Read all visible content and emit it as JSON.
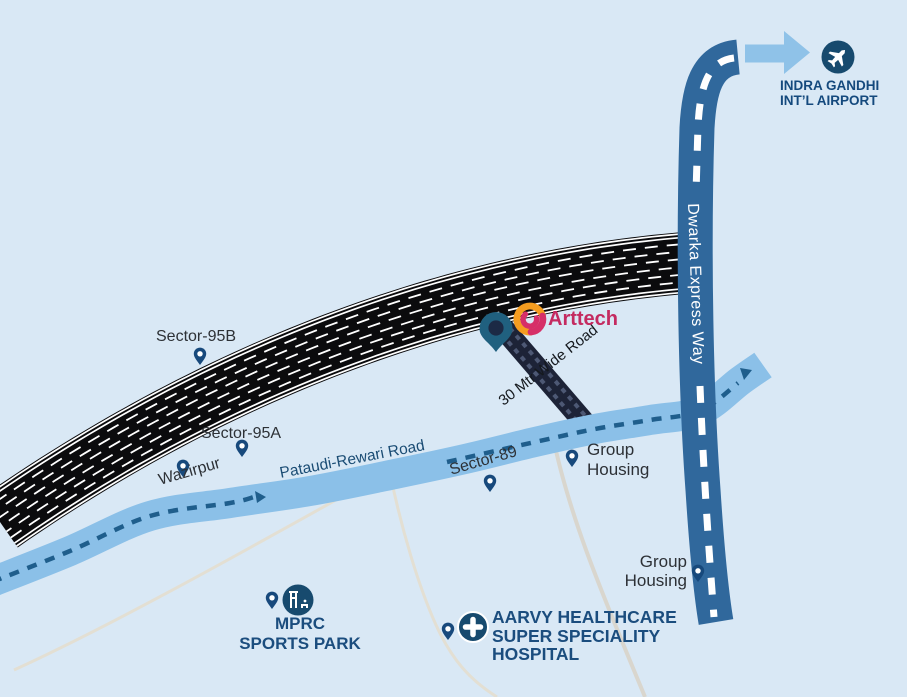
{
  "map_title": "Arttech site location map",
  "colors": {
    "background": "#d9e8f5",
    "highway": "#0b0b0d",
    "marking": "#ffffff",
    "expressway": "#30689c",
    "expressway_dash": "#ffffff",
    "pataudi_road": "#8bc0e8",
    "pataudi_dash": "#1f5e8c",
    "road_30mtr": "#1d2337",
    "road_30mtr_dash": "#4d5874",
    "plot_line": "#e3dfd3",
    "boundary_line": "#d9d6ce",
    "pin_small": "#17497c",
    "pin_main": "#20607f",
    "pin_main_hole": "#1c2a45",
    "icon_circle": "#174a6e",
    "white": "#ffffff",
    "arrow_blue": "#8fc2e8",
    "arttech_orange": "#f59d20",
    "arttech_magenta": "#d62f68",
    "arttech_text": "#c42a60",
    "label_dark": "#2d3136",
    "label_bold_blue": "#1b4d7e",
    "road_label_blue": "#1a4c74"
  },
  "labels": {
    "sector_95b": "Sector-95B",
    "sector_95a": "Sector-95A",
    "wazirpur": "Wazirpur",
    "sector_89": "Sector-89",
    "pataudi_road": "Pataudi-Rewari Road",
    "dwarka_expressway": "Dwarka Express Way",
    "road_30mtr": "30 Mtr Wide Road",
    "group_housing_1_line1": "Group",
    "group_housing_1_line2": "Housing",
    "group_housing_2_line1": "Group",
    "group_housing_2_line2": "Housing",
    "mprc_line1": "MPRC",
    "mprc_line2": "SPORTS PARK",
    "aarvy_line1": "AARVY HEALTHCARE",
    "aarvy_line2": "SUPER SPECIALITY",
    "aarvy_line3": "HOSPITAL",
    "airport_line1": "INDRA GANDHI",
    "airport_line2": "INT’L AIRPORT",
    "brand": "Arttech"
  },
  "icons": {
    "airport": "airplane-icon",
    "hospital": "cross-icon",
    "park": "park-icon",
    "location_pins": "map-pin-icon",
    "airport_direction": "arrow-right-icon",
    "brand_logo": "arttech-swirl-icon"
  }
}
